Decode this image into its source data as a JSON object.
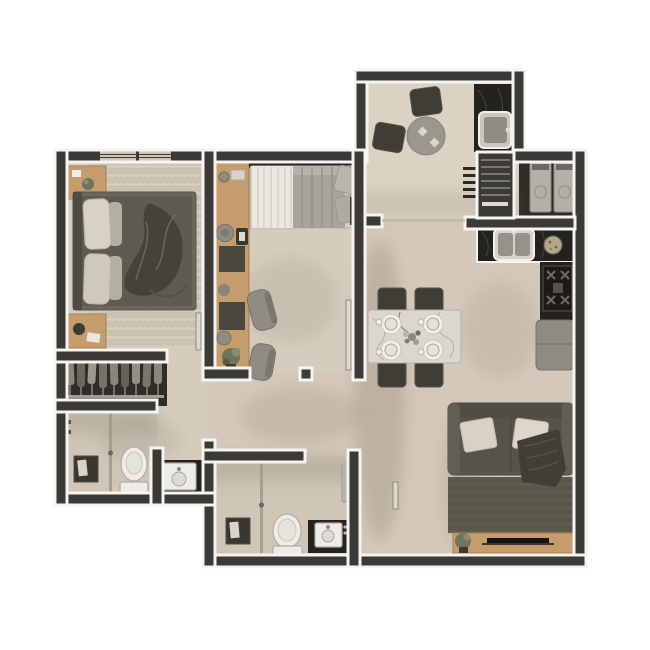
{
  "meta": {
    "description": "3D rendered top-down floor plan of a two-bedroom apartment, no text labels visible",
    "canvas": {
      "width": 650,
      "height": 650
    }
  },
  "palette": {
    "wall": "#3b3a34",
    "casing": "#f5f4f0",
    "floorMain": "#d3c8b9",
    "floorWarm": "#d6ccbd",
    "floorBath": "#cfc6b8",
    "floorBalcony": "#dbd2c4",
    "floorDark": "#2f2d27",
    "counter": "#23221e",
    "wood": "#c59c6c",
    "woodDark": "#a8814f",
    "fixture": "#edece6",
    "fixtureEdge": "#b0ada3",
    "chairDark": "#3f3d36",
    "chairGray": "#8f8c82",
    "sofa": "#5b574c",
    "rugLiving": "#5a574b",
    "rugMaster": "#cbc2b3",
    "duvetMaster": "#5f5b51",
    "blanket": "#45423a",
    "pillowLight": "#d8d2c4",
    "sheet": "#eae8e1",
    "duvetGuest": "#a8a49a",
    "appliance": "#b4b0a7",
    "fridge": "#8e8b82",
    "plant": "#71745c",
    "plantLight": "#8a8d74",
    "pot": "#3c3a32",
    "glass": "#a39d8e",
    "shadow": "#857a69"
  },
  "rooms": [
    {
      "id": "master-bedroom",
      "name": "master bedroom",
      "furniture": [
        "double bed with dark duvet and crumpled blanket",
        "two light pillows",
        "wood nightstand with plant",
        "wood nightstand with lamp and book",
        "light area rug",
        "two windows on top wall"
      ]
    },
    {
      "id": "wardrobe-closet",
      "name": "wardrobe closet",
      "furniture": [
        "row of hanging clothes on rail"
      ]
    },
    {
      "id": "ensuite-bathroom",
      "name": "ensuite bathroom",
      "furniture": [
        "glass shower partition",
        "shower bench",
        "toilet",
        "vanity with round basin in niche"
      ]
    },
    {
      "id": "bedroom-2",
      "name": "second bedroom",
      "furniture": [
        "single bed with white sheet and gray duvet",
        "two pillows",
        "curtain rod",
        "long wood desk",
        "two gray chairs",
        "two stools",
        "potted plant",
        "open door leaf"
      ]
    },
    {
      "id": "bathroom-2",
      "name": "second bathroom",
      "furniture": [
        "glass shower partition",
        "shower bench",
        "toilet",
        "vanity with square sink",
        "wall towel"
      ]
    },
    {
      "id": "balcony",
      "name": "gourmet balcony",
      "furniture": [
        "round bistro table with two small plates",
        "two dark chairs",
        "dark stone counter with sink"
      ]
    },
    {
      "id": "laundry",
      "name": "service / laundry area",
      "furniture": [
        "washer",
        "dryer",
        "striped utility shaft",
        "wall vent grille"
      ]
    },
    {
      "id": "kitchen",
      "name": "kitchen",
      "furniture": [
        "L-shaped dark stone counter",
        "double-bowl sink",
        "round bowl",
        "four-burner cooktop",
        "refrigerator"
      ]
    },
    {
      "id": "dining",
      "name": "dining area",
      "furniture": [
        "marble dining table",
        "four dark chairs",
        "four place settings with plates and cups",
        "flower centerpiece"
      ]
    },
    {
      "id": "living-room",
      "name": "living room",
      "furniture": [
        "dark fabric sofa",
        "two light pillows",
        "throw blanket",
        "dark area rug",
        "wood TV console",
        "flat TV",
        "potted plant"
      ]
    }
  ]
}
